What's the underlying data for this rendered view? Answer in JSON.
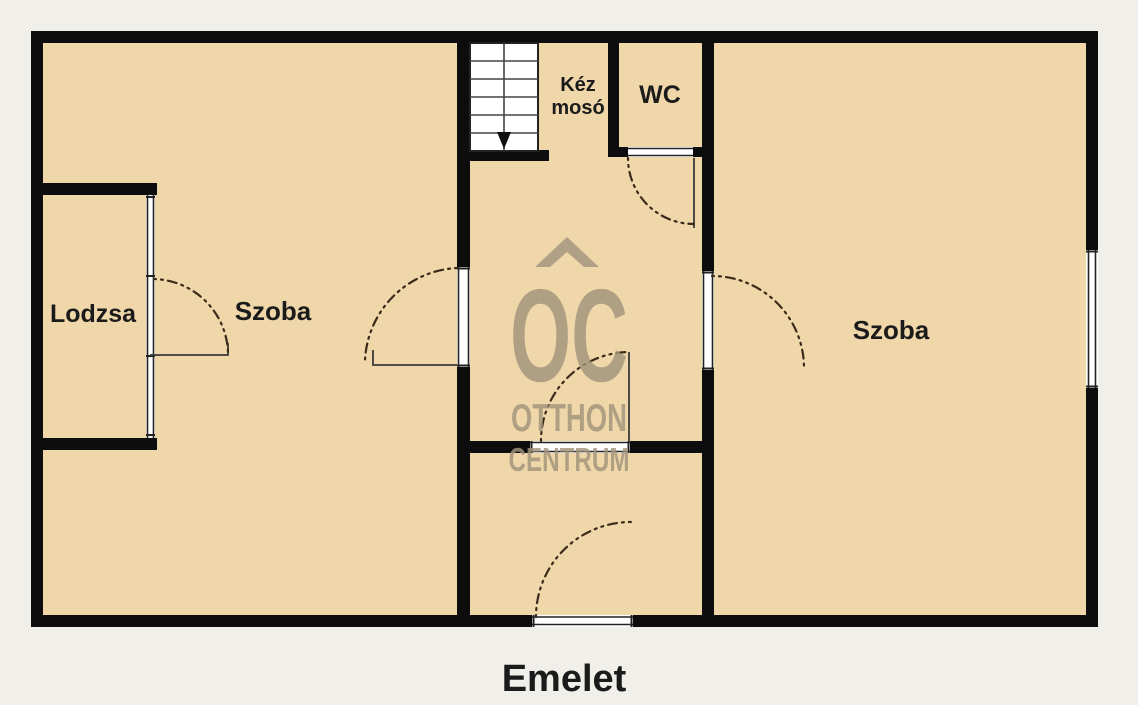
{
  "floor_label": "Emelet",
  "rooms": {
    "lodzsa": "Lodzsa",
    "szoba_left": "Szoba",
    "szoba_right": "Szoba",
    "wc": "WC",
    "kez_line1": "Kéz",
    "kez_line2": "mosó"
  },
  "watermark": {
    "logo": "OC",
    "line1": "OTTHON",
    "line2": "CENTRUM"
  },
  "colors": {
    "background": "#f1efea",
    "floor": "#f0d7aa",
    "wall": "#0d0d0d",
    "opening": "#ffffff",
    "arc": "#3a2b1a",
    "label": "#1b1b1b",
    "watermark": "#a1947c"
  }
}
